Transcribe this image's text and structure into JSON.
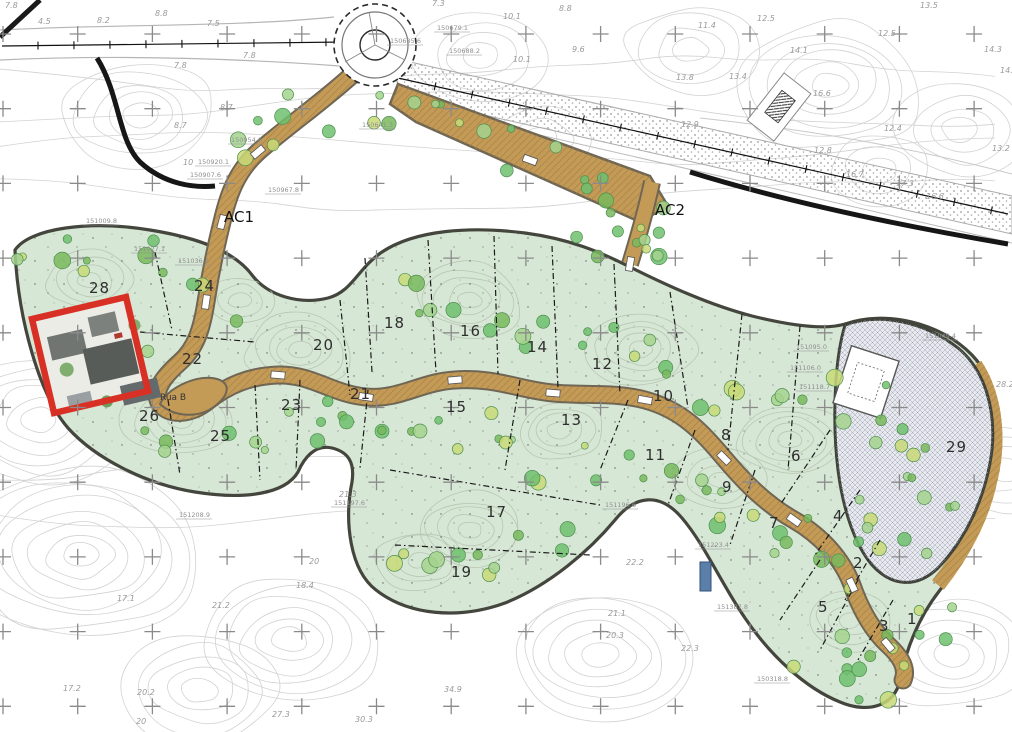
{
  "map": {
    "area_labels": [
      {
        "text": "AC1",
        "x": 224,
        "y": 222
      },
      {
        "text": "AC2",
        "x": 655,
        "y": 215
      }
    ],
    "street_labels": [
      {
        "text": "Rua B",
        "x": 160,
        "y": 400
      }
    ],
    "lot_labels": [
      {
        "n": "1",
        "x": 907,
        "y": 624
      },
      {
        "n": "2",
        "x": 853,
        "y": 568
      },
      {
        "n": "3",
        "x": 879,
        "y": 631
      },
      {
        "n": "4",
        "x": 833,
        "y": 521
      },
      {
        "n": "5",
        "x": 818,
        "y": 612
      },
      {
        "n": "6",
        "x": 791,
        "y": 461
      },
      {
        "n": "7",
        "x": 769,
        "y": 528
      },
      {
        "n": "8",
        "x": 721,
        "y": 440
      },
      {
        "n": "9",
        "x": 722,
        "y": 492
      },
      {
        "n": "10",
        "x": 653,
        "y": 401
      },
      {
        "n": "11",
        "x": 645,
        "y": 460
      },
      {
        "n": "12",
        "x": 592,
        "y": 369
      },
      {
        "n": "13",
        "x": 561,
        "y": 425
      },
      {
        "n": "14",
        "x": 527,
        "y": 352
      },
      {
        "n": "15",
        "x": 446,
        "y": 412
      },
      {
        "n": "16",
        "x": 460,
        "y": 336
      },
      {
        "n": "17",
        "x": 486,
        "y": 517
      },
      {
        "n": "18",
        "x": 384,
        "y": 328
      },
      {
        "n": "19",
        "x": 451,
        "y": 577
      },
      {
        "n": "20",
        "x": 313,
        "y": 350
      },
      {
        "n": "21",
        "x": 350,
        "y": 399
      },
      {
        "n": "22",
        "x": 182,
        "y": 364
      },
      {
        "n": "23",
        "x": 281,
        "y": 410
      },
      {
        "n": "24",
        "x": 194,
        "y": 291
      },
      {
        "n": "25",
        "x": 210,
        "y": 441
      },
      {
        "n": "26",
        "x": 139,
        "y": 421
      },
      {
        "n": "28",
        "x": 89,
        "y": 293
      },
      {
        "n": "29",
        "x": 946,
        "y": 452
      }
    ],
    "elevation_labels": [
      {
        "t": "7.8",
        "x": 5,
        "y": 8
      },
      {
        "t": "8.8",
        "x": 155,
        "y": 16
      },
      {
        "t": "8.2",
        "x": 97,
        "y": 23
      },
      {
        "t": "4.5",
        "x": 38,
        "y": 24
      },
      {
        "t": "7.5",
        "x": 207,
        "y": 26
      },
      {
        "t": "7.3",
        "x": 432,
        "y": 6
      },
      {
        "t": "10.1",
        "x": 503,
        "y": 19
      },
      {
        "t": "8.8",
        "x": 559,
        "y": 11
      },
      {
        "t": "9.6",
        "x": 572,
        "y": 52
      },
      {
        "t": "10.1",
        "x": 513,
        "y": 62
      },
      {
        "t": "7.8",
        "x": 174,
        "y": 68
      },
      {
        "t": "7.8",
        "x": 243,
        "y": 58
      },
      {
        "t": "8.7",
        "x": 220,
        "y": 110
      },
      {
        "t": "8.7",
        "x": 174,
        "y": 128
      },
      {
        "t": "10",
        "x": 183,
        "y": 165
      },
      {
        "t": "11.4",
        "x": 698,
        "y": 28
      },
      {
        "t": "12.5",
        "x": 757,
        "y": 21
      },
      {
        "t": "12.5",
        "x": 878,
        "y": 36
      },
      {
        "t": "13.5",
        "x": 920,
        "y": 8
      },
      {
        "t": "14.1",
        "x": 790,
        "y": 53
      },
      {
        "t": "14.3",
        "x": 984,
        "y": 52
      },
      {
        "t": "14.6",
        "x": 1000,
        "y": 73
      },
      {
        "t": "13.8",
        "x": 676,
        "y": 80
      },
      {
        "t": "13.4",
        "x": 729,
        "y": 79
      },
      {
        "t": "16.6",
        "x": 813,
        "y": 96
      },
      {
        "t": "12.9",
        "x": 681,
        "y": 127
      },
      {
        "t": "12.4",
        "x": 884,
        "y": 131
      },
      {
        "t": "13.2",
        "x": 992,
        "y": 151
      },
      {
        "t": "12.8",
        "x": 814,
        "y": 153
      },
      {
        "t": "16.7",
        "x": 846,
        "y": 177
      },
      {
        "t": "17.3",
        "x": 896,
        "y": 186
      },
      {
        "t": "16.6",
        "x": 926,
        "y": 199
      },
      {
        "t": "28.2",
        "x": 996,
        "y": 387
      },
      {
        "t": "21.3",
        "x": 339,
        "y": 497
      },
      {
        "t": "20",
        "x": 309,
        "y": 564
      },
      {
        "t": "18.4",
        "x": 296,
        "y": 588
      },
      {
        "t": "21.2",
        "x": 212,
        "y": 608
      },
      {
        "t": "17.1",
        "x": 117,
        "y": 601
      },
      {
        "t": "17.2",
        "x": 63,
        "y": 691
      },
      {
        "t": "20.2",
        "x": 137,
        "y": 695
      },
      {
        "t": "20",
        "x": 136,
        "y": 724
      },
      {
        "t": "27.3",
        "x": 272,
        "y": 717
      },
      {
        "t": "30.3",
        "x": 355,
        "y": 722
      },
      {
        "t": "34.9",
        "x": 444,
        "y": 692
      },
      {
        "t": "22.2",
        "x": 626,
        "y": 565
      },
      {
        "t": "21.1",
        "x": 608,
        "y": 616
      },
      {
        "t": "20.3",
        "x": 606,
        "y": 638
      },
      {
        "t": "22.3",
        "x": 681,
        "y": 651
      }
    ],
    "coordinate_labels": [
      {
        "t": "150685.6",
        "x": 390,
        "y": 43
      },
      {
        "t": "150679.1",
        "x": 437,
        "y": 30
      },
      {
        "t": "150688.2",
        "x": 449,
        "y": 53
      },
      {
        "t": "150641.3",
        "x": 362,
        "y": 127
      },
      {
        "t": "150954.6",
        "x": 231,
        "y": 142
      },
      {
        "t": "150920.1",
        "x": 198,
        "y": 164
      },
      {
        "t": "150907.6",
        "x": 190,
        "y": 177
      },
      {
        "t": "150967.8",
        "x": 268,
        "y": 192
      },
      {
        "t": "151009.8",
        "x": 86,
        "y": 223
      },
      {
        "t": "151027.1",
        "x": 134,
        "y": 251
      },
      {
        "t": "151036.4",
        "x": 178,
        "y": 263
      },
      {
        "t": "151049.4",
        "x": 925,
        "y": 338
      },
      {
        "t": "151095.0",
        "x": 796,
        "y": 349
      },
      {
        "t": "151106.0",
        "x": 790,
        "y": 370
      },
      {
        "t": "151118.7",
        "x": 799,
        "y": 389
      },
      {
        "t": "151196.6",
        "x": 605,
        "y": 507
      },
      {
        "t": "151208.9",
        "x": 179,
        "y": 517
      },
      {
        "t": "151197.6",
        "x": 334,
        "y": 505
      },
      {
        "t": "151223.4",
        "x": 698,
        "y": 547
      },
      {
        "t": "151387.8",
        "x": 717,
        "y": 609
      },
      {
        "t": "150318.8",
        "x": 757,
        "y": 681
      }
    ],
    "survey_grid": {
      "x_start": 3,
      "y_start": 34,
      "step": 74.7,
      "cols": 14,
      "rows": 10,
      "arm": 8
    },
    "colors": {
      "lot_fill": "#d7e7d6",
      "road_fill": "#c49a57",
      "road_edge": "#6f6654",
      "boundary": "#44463d",
      "contour_outer": "#d2d2d2",
      "contour_inner": "#b7c7b1",
      "red_outline": "#d93025",
      "cross": "#8a8a8a",
      "tree_dark": "#6fbf6f",
      "tree_light": "#a5d48e",
      "tree_yellow": "#c9d978",
      "highway_dot": "#9a9a9a",
      "blue_marker": "#5b7fa8",
      "label": "#2e2e2e",
      "elevation": "#9a9a9a",
      "coordinate": "#8f8f8f"
    }
  }
}
